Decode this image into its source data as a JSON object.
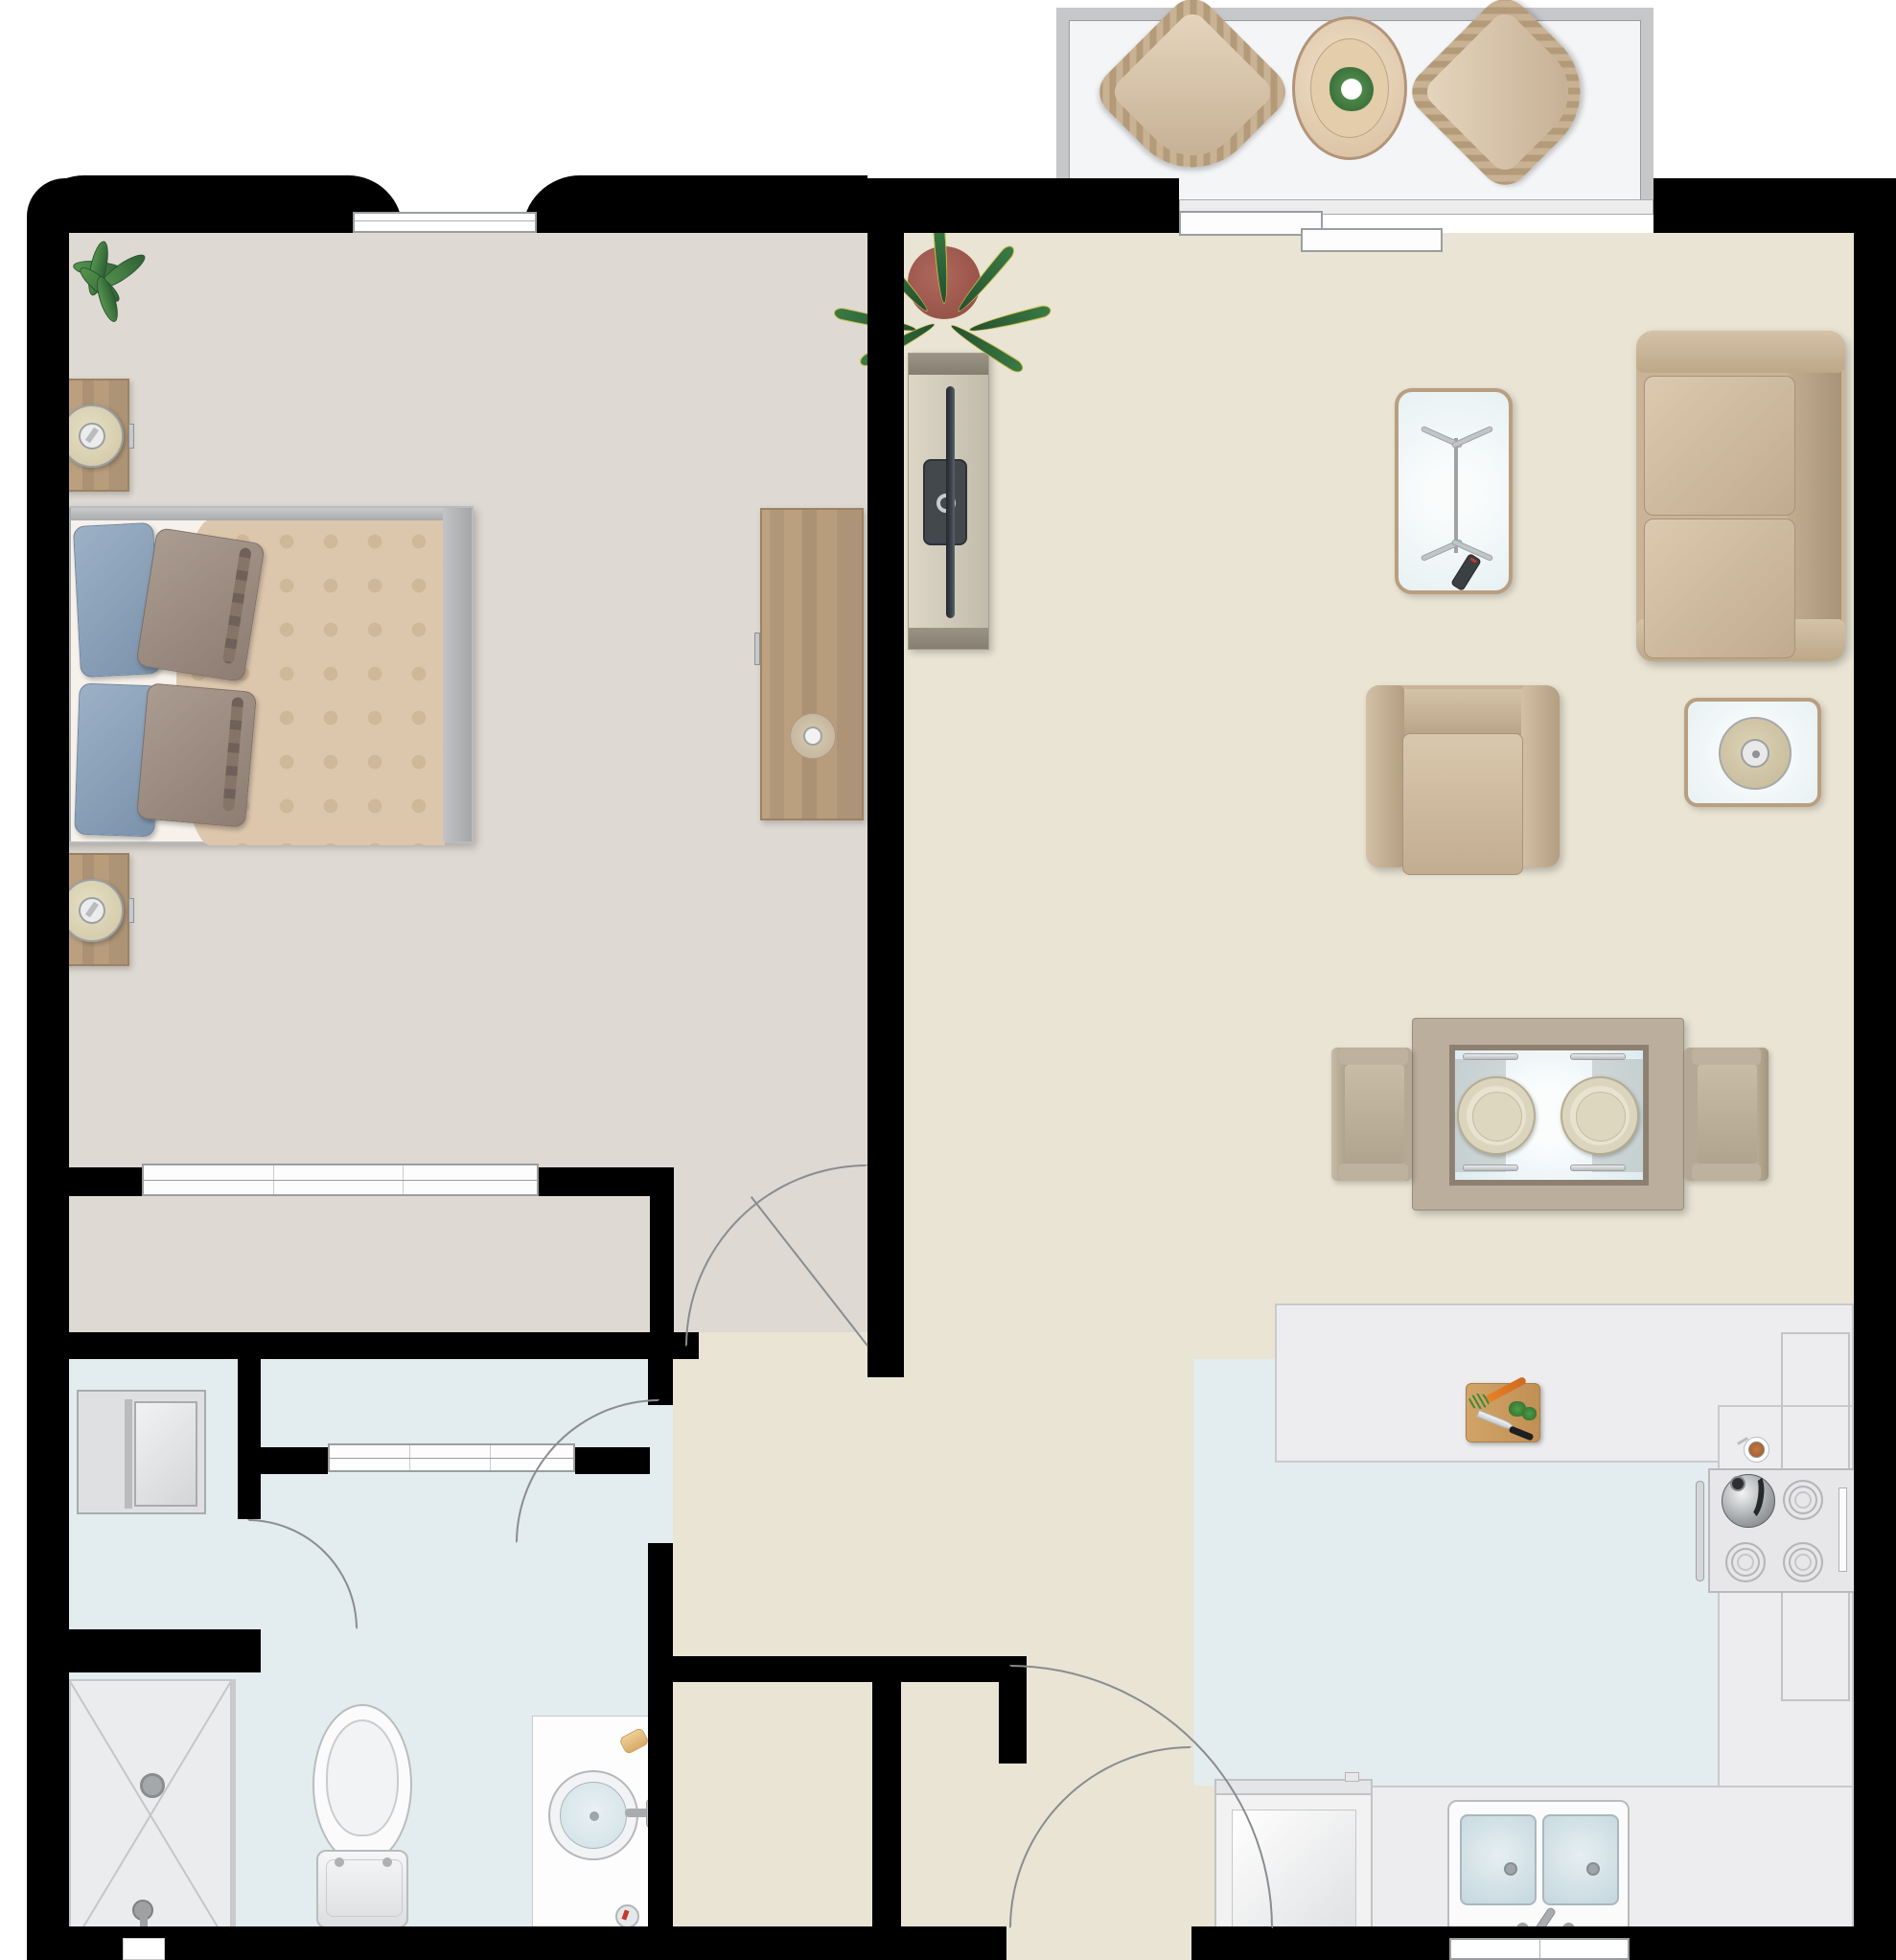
{
  "title": "one-bedroom apartment floor plan (top-down)",
  "colors": {
    "wall": "#000000",
    "bedroom_floor": "#ded9d2",
    "living_floor": "#e9e4d4",
    "wet_floor": "#e3ecef",
    "counter": "#ededef",
    "balcony_floor": "#f3f5f6",
    "frame_gray": "#c6c7c9",
    "tan": "#cdb79e",
    "wood": "#b89c7c",
    "duvet": "#dcc6ac",
    "sheet": "#f6f1ea",
    "pillow_blue": "#8fa5bc",
    "pillow_taupe": "#a39389",
    "glass": "#edf4f6",
    "fixture_white": "#fbfbfc",
    "basin_blue": "#d3e2e8",
    "plant_green": "#3e7c46",
    "pot_terracotta": "#a35b50",
    "board_wood": "#c89a62",
    "line": "#8a8d8f"
  },
  "rooms": [
    {
      "id": "bedroom",
      "label": "bedroom"
    },
    {
      "id": "living-room",
      "label": "living room"
    },
    {
      "id": "kitchen",
      "label": "kitchen"
    },
    {
      "id": "bathroom",
      "label": "bathroom"
    },
    {
      "id": "hallway-entry",
      "label": "entry hallway"
    },
    {
      "id": "balcony",
      "label": "balcony"
    },
    {
      "id": "bedroom-closet",
      "label": "bedroom closet with sliding doors"
    },
    {
      "id": "linen-closet",
      "label": "linen closet with sliding doors"
    },
    {
      "id": "laundry-closet",
      "label": "laundry closet"
    },
    {
      "id": "shower-room",
      "label": "shower stall"
    }
  ],
  "furniture": {
    "balcony": [
      "wicker patio chair",
      "wicker patio chair",
      "oval patio table with flower centerpiece"
    ],
    "bedroom": [
      "potted plant",
      "nightstand with lamp",
      "nightstand with lamp",
      "queen bed with blue and taupe pillows",
      "dresser with tray and cup"
    ],
    "living_room": [
      "potted sansevieria plant",
      "tv console with wall-mounted tv",
      "glass coffee table with remote control",
      "two-cushion sofa",
      "armchair",
      "glass side table with lamp",
      "dining table with two place settings",
      "dining chair",
      "dining chair"
    ],
    "kitchen": [
      "peninsula counter",
      "cutting board with carrot, broccoli and knife",
      "range with four burners and kettle",
      "coffee cup on saucer",
      "double-basin sink with faucet",
      "dishwasher"
    ],
    "bathroom": [
      "washing machine",
      "tiled shower with drain and shower head",
      "toilet",
      "vanity with round sink, soap and toothbrush cup"
    ]
  },
  "openings": {
    "windows": [
      "bedroom window (north wall)",
      "kitchen window (south wall below sink)"
    ],
    "doors": [
      "balcony sliding glass door",
      "bedroom closet sliding doors",
      "linen closet sliding doors",
      "bedroom hinged door",
      "bathroom hinged door",
      "laundry closet hinged door",
      "front entry door",
      "entry closet door"
    ]
  }
}
